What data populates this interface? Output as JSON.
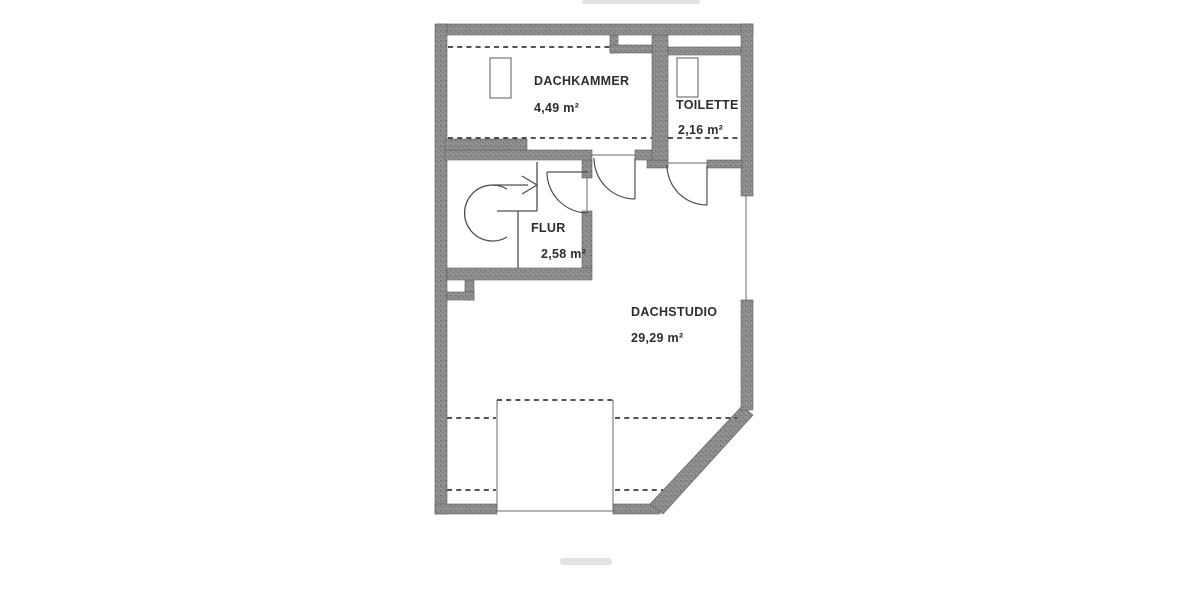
{
  "plan": {
    "rooms": [
      {
        "id": "dachkammer",
        "name": "DACHKAMMER",
        "area": "4,49 m²"
      },
      {
        "id": "toilette",
        "name": "TOILETTE",
        "area": "2,16 m²"
      },
      {
        "id": "flur",
        "name": "FLUR",
        "area": "2,58 m²"
      },
      {
        "id": "dachstudio",
        "name": "DACHSTUDIO",
        "area": "29,29 m²"
      }
    ],
    "colors": {
      "wall": "#8d8d8d",
      "line": "#4f4f4f",
      "dashed_line": "#3c3c3c",
      "text": "#2d2d2d",
      "background": "#ffffff"
    }
  }
}
